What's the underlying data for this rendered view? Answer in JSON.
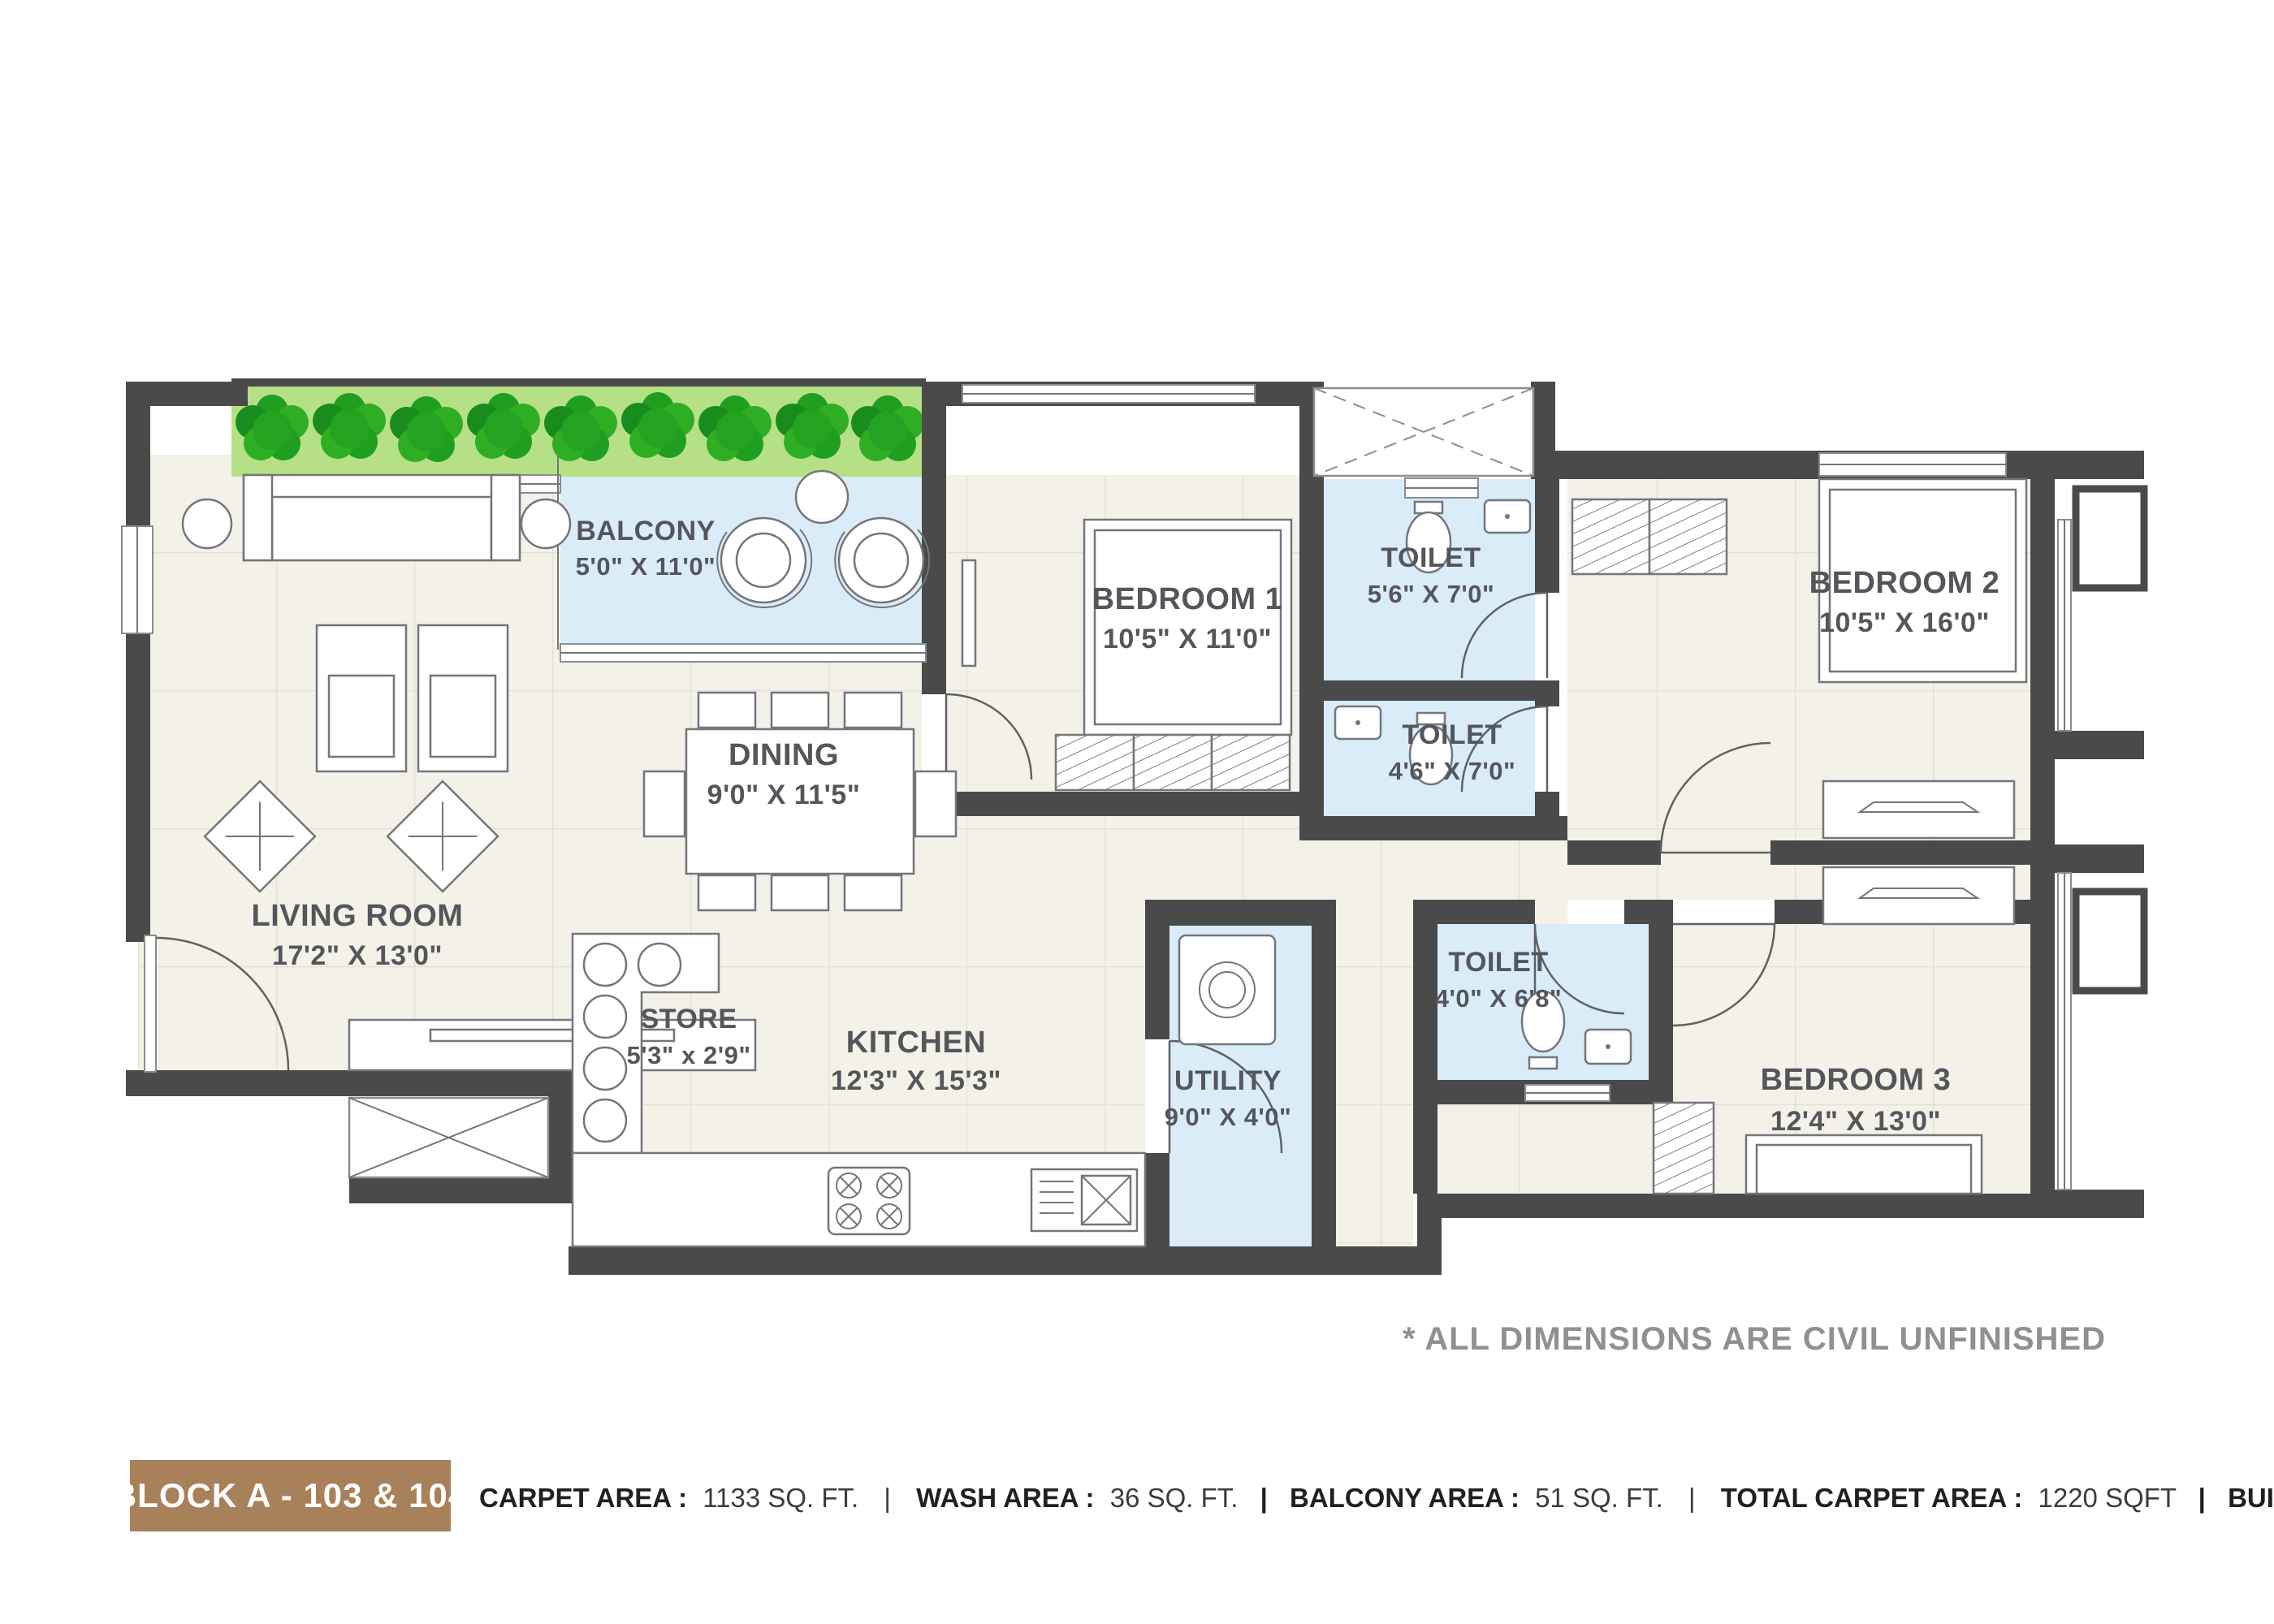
{
  "plan": {
    "note": "* ALL DIMENSIONS ARE CIVIL UNFINISHED",
    "rooms": {
      "living": {
        "name": "LIVING ROOM",
        "dims": "17'2\" X 13'0\""
      },
      "dining": {
        "name": "DINING",
        "dims": "9'0\" X 11'5\""
      },
      "balcony": {
        "name": "BALCONY",
        "dims": "5'0\" X 11'0\""
      },
      "store": {
        "name": "STORE",
        "dims": "5'3\" x 2'9\""
      },
      "kitchen": {
        "name": "KITCHEN",
        "dims": "12'3\" X 15'3\""
      },
      "utility": {
        "name": "UTILITY",
        "dims": "9'0\" X 4'0\""
      },
      "bedroom1": {
        "name": "BEDROOM 1",
        "dims": "10'5\" X 11'0\""
      },
      "bedroom2": {
        "name": "BEDROOM 2",
        "dims": "10'5\" X 16'0\""
      },
      "bedroom3": {
        "name": "BEDROOM 3",
        "dims": "12'4\" X 13'0\""
      },
      "toilet1": {
        "name": "TOILET",
        "dims": "5'6\" X 7'0\""
      },
      "toilet2": {
        "name": "TOILET",
        "dims": "4'6\" X 7'0\""
      },
      "toilet3": {
        "name": "TOILET",
        "dims": "4'0\" X 6'8\""
      }
    }
  },
  "footer": {
    "block_label": "BLOCK A - 103 & 104",
    "sep": "|",
    "stats": [
      {
        "label": "CARPET AREA :",
        "value": "1133 SQ. FT."
      },
      {
        "label": "WASH AREA :",
        "value": "36 SQ. FT."
      },
      {
        "label": "BALCONY AREA :",
        "value": "51 SQ. FT."
      },
      {
        "label": "TOTAL CARPET AREA :",
        "value": "1220 SQFT"
      },
      {
        "label": "BUILTUP AREA :",
        "value": "1287 SQ. FT."
      }
    ]
  },
  "colors": {
    "wall": "#4a4a4b",
    "floor": "#f3f1e8",
    "wet_area": "#d9ecf8",
    "greenery": "#b5e086",
    "bush": "#1f9e1f",
    "block_bar": "#a8805a",
    "label_text": "#54565b",
    "note_text": "#8f9092"
  }
}
